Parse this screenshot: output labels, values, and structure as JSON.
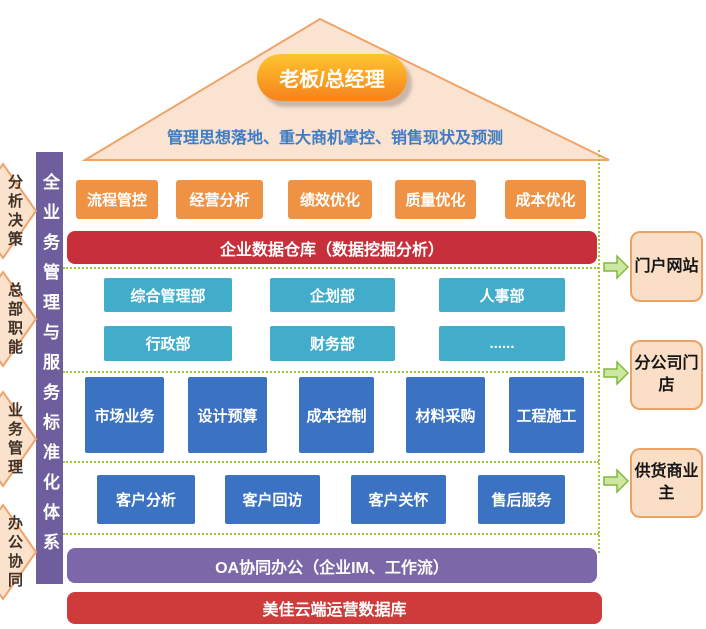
{
  "roof": {
    "leader": "老板/总经理",
    "subtitle": "管理思想落地、重大商机掌控、销售现状及预测"
  },
  "left_rail": {
    "title": "全业务管理与服务标准化体系",
    "arrows": [
      "分析决策",
      "总部职能",
      "业务管理",
      "办公协同"
    ]
  },
  "management_row": [
    "流程管控",
    "经营分析",
    "绩效优化",
    "质量优化",
    "成本优化"
  ],
  "data_warehouse": {
    "label": "企业数据仓库（数据挖掘分析）"
  },
  "departments": {
    "row1": [
      "综合管理部",
      "企划部",
      "人事部"
    ],
    "row2": [
      "行政部",
      "财务部",
      "......"
    ]
  },
  "business": [
    "市场业务",
    "设计预算",
    "成本控制",
    "材料采购",
    "工程施工"
  ],
  "customer": [
    "客户分析",
    "客户回访",
    "客户关怀",
    "售后服务"
  ],
  "oa": {
    "label": "OA协同办公（企业IM、工作流）"
  },
  "cloud_db": {
    "label": "美佳云端运营数据库"
  },
  "right_channels": [
    "门户网站",
    "分公司门店",
    "供货商业主"
  ],
  "palette": {
    "roof_fill": "#FBE3D2",
    "roof_border": "#F0A468",
    "badge_orange": "#F6881F",
    "button_orange": "#EF9243",
    "warehouse_red": "#C7303A",
    "cloud_red": "#CE3B3B",
    "dept_teal": "#41ADCB",
    "business_blue": "#3B72C1",
    "oa_purple": "#7C68A8",
    "rail_purple": "#6F5E9D",
    "dotted_green": "#9CC83F",
    "arrow_green": "#CDE6A0",
    "channel_peach": "#FBDEC6"
  }
}
